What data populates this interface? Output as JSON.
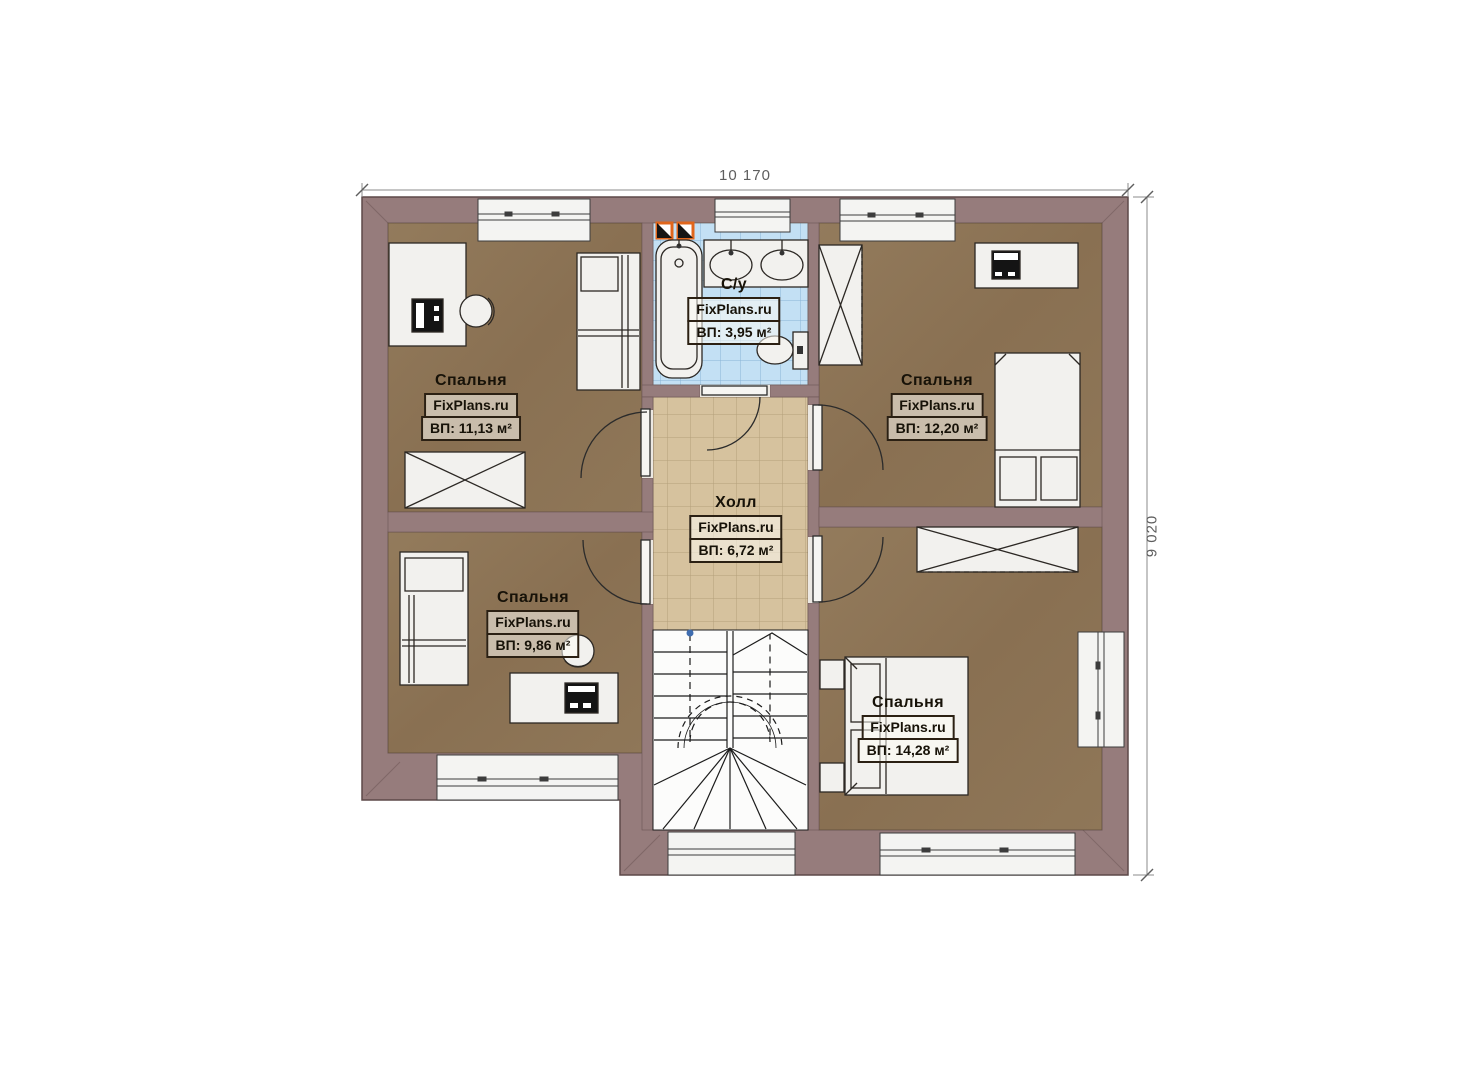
{
  "dimensions": {
    "width": "10 170",
    "height": "9 020"
  },
  "rooms": {
    "bedroom_top_left": {
      "name": "Спальня",
      "brand": "FixPlans.ru",
      "area": "ВП: 11,13 м²"
    },
    "bathroom": {
      "name": "С/у",
      "brand": "FixPlans.ru",
      "area": "ВП: 3,95 м²"
    },
    "bedroom_top_right": {
      "name": "Спальня",
      "brand": "FixPlans.ru",
      "area": "ВП: 12,20 м²"
    },
    "hall": {
      "name": "Холл",
      "brand": "FixPlans.ru",
      "area": "ВП: 6,72 м²"
    },
    "bedroom_bottom_left": {
      "name": "Спальня",
      "brand": "FixPlans.ru",
      "area": "ВП: 9,86 м²"
    },
    "bedroom_bottom_right": {
      "name": "Спальня",
      "brand": "FixPlans.ru",
      "area": "ВП: 14,28 м²"
    }
  },
  "colors": {
    "wall": "#967c7c",
    "bedroom_floor": "#8c7456",
    "hall_floor": "#d6c29e",
    "bathroom_floor": "#c3e0f4",
    "stair_floor": "#fcfcfb",
    "vent_accent": "#e0661c",
    "dimension_text": "#5e5e5e"
  }
}
